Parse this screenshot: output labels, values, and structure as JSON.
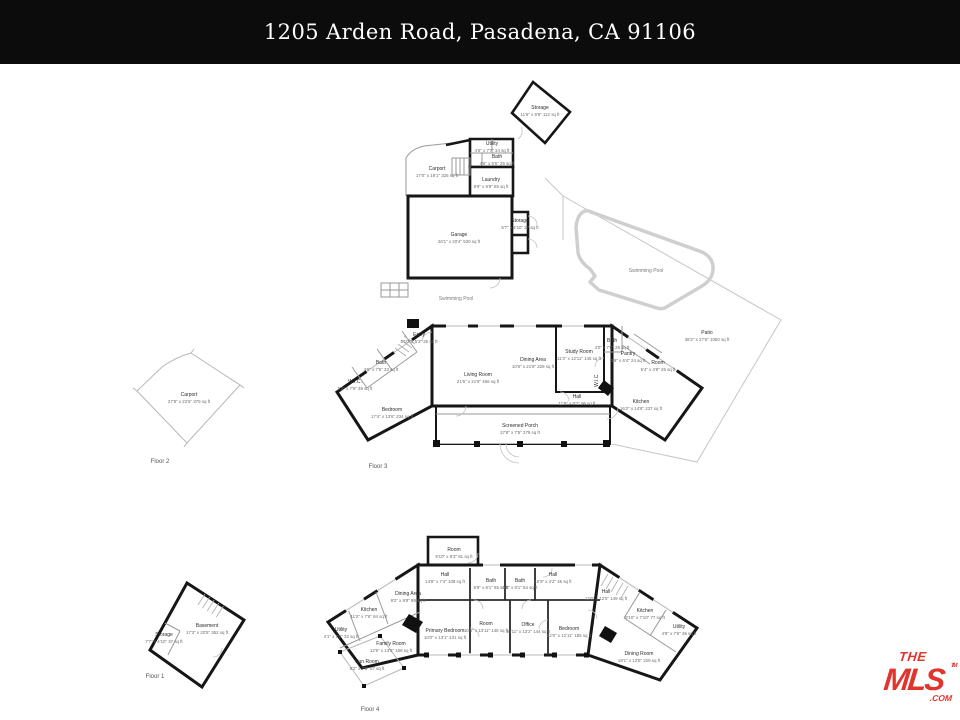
{
  "header": {
    "title": "1205 Arden Road, Pasadena, CA 91106"
  },
  "pool_label": "Swimming Pool",
  "captions": {
    "floor1": "Floor 1",
    "floor2": "Floor 2",
    "floor3": "Floor 3",
    "floor4": "Floor 4"
  },
  "rooms": {
    "storage_top": {
      "name": "Storage",
      "size": "11'6\" x 9'9\" 112 sq ft"
    },
    "utility_top": {
      "name": "Utility",
      "size": "4'6\" x 7'7\" 34 sq ft"
    },
    "bath_top": {
      "name": "Bath",
      "size": "4'6\" x 5'6\" 25 sq ft"
    },
    "carport_top": {
      "name": "Carport",
      "size": "17'0\" x 19'1\" 325 sq ft"
    },
    "laundry": {
      "name": "Laundry",
      "size": "8'9\" x 9'8\" 85 sq ft"
    },
    "garage": {
      "name": "Garage",
      "size": "26'1\" x 20'4\" 530 sq ft"
    },
    "storage_gar": {
      "name": "Storage",
      "size": "5'7\" x 4'10\" 27 sq ft"
    },
    "entry": {
      "name": "Entry",
      "size": "4'10\" x 5'3\" 25 sq ft"
    },
    "bath_m1": {
      "name": "Bath",
      "size": "4'6\" x 7'5\" 33 sq ft"
    },
    "wic_m": {
      "name": "W.I.C.",
      "size": "5'2\" x 7'6\" 39 sq ft"
    },
    "bedroom_m": {
      "name": "Bedroom",
      "size": "17'4\" x 13'6\" 234 sq ft"
    },
    "living": {
      "name": "Living Room",
      "size": "21'6\" x 21'8\" 466 sq ft"
    },
    "dining_m": {
      "name": "Dining Area",
      "size": "10'6\" x 21'8\" 228 sq ft"
    },
    "study": {
      "name": "Study Room",
      "size": "11'3\" x 12'11\" 145 sq ft"
    },
    "bath_m2": {
      "name": "Bath",
      "size": "4'0\" x 7'0\" 28 sq ft"
    },
    "pantry_m": {
      "name": "Pantry",
      "size": "3'9\" x 6'4\" 24 sq ft"
    },
    "room_m": {
      "name": "Room",
      "size": "5'4\" x 4'9\" 25 sq ft"
    },
    "wic_m2": {
      "name": "W.I.C."
    },
    "hall_m": {
      "name": "Hall",
      "size": "11'9\" x 8'2\" 96 sq ft"
    },
    "kitchen_m": {
      "name": "Kitchen",
      "size": "16'2\" x 14'8\" 237 sq ft"
    },
    "patio": {
      "name": "Patio",
      "size": "38'2\" x 27'6\" 1050 sq ft"
    },
    "porch": {
      "name": "Screened Porch",
      "size": "37'8\" x 7'5\" 279 sq ft"
    },
    "carport_l": {
      "name": "Carport",
      "size": "27'8\" x 22'6\" 379 sq ft"
    },
    "basement": {
      "name": "Basement",
      "size": "17'3\" x 20'5\" 352 sq ft"
    },
    "storage_b": {
      "name": "Storage",
      "size": "7'7\" x 4'10\" 37 sq ft"
    },
    "room_b": {
      "name": "Room",
      "size": "9'10\" x 8'3\" 81 sq ft"
    },
    "hall_b1": {
      "name": "Hall",
      "size": "14'8\" x 7'4\" 108 sq ft"
    },
    "bath_b1": {
      "name": "Bath",
      "size": "6'9\" x 8'1\" 55 sq ft"
    },
    "bath_b2": {
      "name": "Bath",
      "size": "6'8\" x 8'1\" 54 sq ft"
    },
    "hall_b2": {
      "name": "Hall",
      "size": "10'9\" x 4'2\" 45 sq ft"
    },
    "dining_b": {
      "name": "Dining Area",
      "size": "9'2\" x 9'8\" 89 sq ft"
    },
    "kitchen_b1": {
      "name": "Kitchen",
      "size": "11'2\" x 7'6\" 84 sq ft"
    },
    "utility_b1": {
      "name": "Utility",
      "size": "4'1\" x 7'9\" 32 sq ft"
    },
    "primary": {
      "name": "Primary Bedroom",
      "size": "10'0\" x 13'1\" 131 sq ft"
    },
    "room_b2": {
      "name": "Room",
      "size": "10'6\" x 13'11\" 146 sq ft"
    },
    "office": {
      "name": "Office",
      "size": "10'11\" x 13'2\" 144 sq ft"
    },
    "bedroom_b1": {
      "name": "Bedroom",
      "size": "12'0\" x 12'11\" 155 sq ft"
    },
    "family": {
      "name": "Family Room",
      "size": "12'5\" x 13'6\" 168 sq ft"
    },
    "sunroom": {
      "name": "Sun Room",
      "size": "8'2\" x 7'0\" 57 sq ft"
    },
    "hall_b3": {
      "name": "Hall",
      "size": "12'0\" x 12'5\" 149 sq ft"
    },
    "kitchen_b2": {
      "name": "Kitchen",
      "size": "9'10\" x 7'10\" 77 sq ft"
    },
    "utility_b2": {
      "name": "Utility",
      "size": "4'9\" x 7'6\" 36 sq ft"
    },
    "dining_room": {
      "name": "Dining Room",
      "size": "18'1\" x 12'8\" 229 sq ft"
    }
  },
  "logo": {
    "the": "THE",
    "mls": "MLS",
    "tm": "TM",
    "com": ".COM"
  },
  "colors": {
    "logo_red": "#e1342c",
    "wall": "#161616",
    "header_bg": "#0c0c0c"
  }
}
